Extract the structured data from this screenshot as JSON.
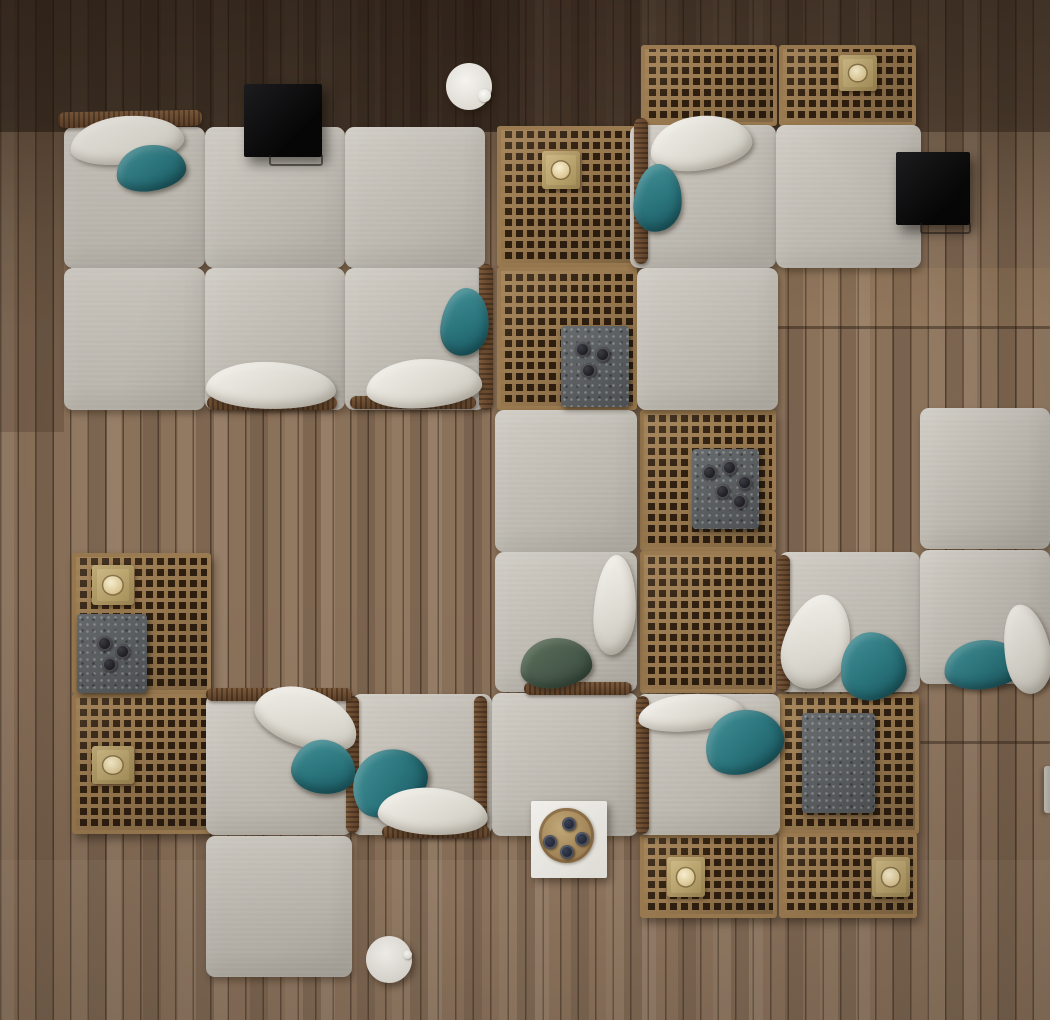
{
  "scene": {
    "title": "Overhead 3D render: modular outdoor lounge sofas with lattice wood coffee tables, teal and white pillows, stone trays and brass candle blocks on a plank deck",
    "canvas": {
      "width": 1050,
      "height": 1020
    },
    "palette": {
      "deck_wood": "#8a715a",
      "deck_wood_dark": "#54422f",
      "plank_line": "#2d1e12",
      "lattice_wood": "#9a7a50",
      "lattice_hole": "#2f1f10",
      "cushion_fabric": "#c3bfb6",
      "pillow_white": "#ece9e2",
      "pillow_teal": "#2d747c",
      "pillow_green": "#47594a",
      "stone_tray": "#5d5f61",
      "brass": "#b59c68",
      "candle_wax": "#f0e4bd",
      "black_table": "#101012",
      "white_table": "#ecebe6",
      "wood_tray": "#b09064",
      "wicker_frame": "#6b4c30"
    },
    "floor": {
      "description": "vertical timber planks, darker at top, lighter toward bottom",
      "plank_width_px": 18
    },
    "items": [
      {
        "name": "floor-shade-top",
        "type": "shade",
        "x": 0,
        "y": 0,
        "w": 1050,
        "h": 132,
        "color": "rgba(28,19,12,0.38)"
      },
      {
        "name": "floor-shade-top-left",
        "type": "shade",
        "x": 0,
        "y": 0,
        "w": 520,
        "h": 132,
        "color": "rgba(24,16,10,0.30)"
      },
      {
        "name": "floor-shade-left-strip",
        "type": "shade",
        "x": 0,
        "y": 132,
        "w": 64,
        "h": 300,
        "color": "rgba(44,31,20,0.20)"
      },
      {
        "name": "floor-shade-mid-top",
        "type": "shade",
        "x": 380,
        "y": 0,
        "w": 260,
        "h": 130,
        "color": "rgba(30,20,13,0.22)"
      },
      {
        "name": "floor-shade-bottom-light",
        "type": "shade",
        "x": 0,
        "y": 860,
        "w": 1050,
        "h": 160,
        "color": "rgba(255,238,214,0.05)"
      },
      {
        "name": "floor-shade-right-gold",
        "type": "shade",
        "x": 778,
        "y": 268,
        "w": 272,
        "h": 58,
        "color": "rgba(214,172,120,0.10)"
      },
      {
        "name": "plank-seam-right-upper",
        "type": "seam",
        "x": 776,
        "y": 326,
        "w": 274,
        "h": 3
      },
      {
        "name": "plank-seam-right-lower",
        "type": "seam",
        "x": 920,
        "y": 741,
        "w": 130,
        "h": 3
      },
      {
        "name": "lattice-panel-mid-top",
        "type": "lattice",
        "x": 497,
        "y": 126,
        "w": 140,
        "h": 141
      },
      {
        "name": "lattice-panel-mid-second",
        "type": "lattice",
        "x": 497,
        "y": 267,
        "w": 140,
        "h": 143
      },
      {
        "name": "lattice-panel-topright-left",
        "type": "lattice",
        "x": 641,
        "y": 45,
        "w": 136,
        "h": 81
      },
      {
        "name": "lattice-panel-topright-right",
        "type": "lattice",
        "x": 779,
        "y": 45,
        "w": 137,
        "h": 81
      },
      {
        "name": "lattice-panel-center-right-upper",
        "type": "lattice",
        "x": 640,
        "y": 410,
        "w": 136,
        "h": 141
      },
      {
        "name": "lattice-panel-center-right-lower",
        "type": "lattice",
        "x": 640,
        "y": 551,
        "w": 136,
        "h": 142
      },
      {
        "name": "lattice-panel-right-tray",
        "type": "lattice",
        "x": 777,
        "y": 694,
        "w": 142,
        "h": 140
      },
      {
        "name": "lattice-panel-bottom-pair-left",
        "type": "lattice",
        "x": 640,
        "y": 834,
        "w": 137,
        "h": 84
      },
      {
        "name": "lattice-panel-bottom-pair-right",
        "type": "lattice",
        "x": 779,
        "y": 833,
        "w": 138,
        "h": 85
      },
      {
        "name": "lattice-panel-west-upper",
        "type": "lattice",
        "x": 72,
        "y": 553,
        "w": 139,
        "h": 141
      },
      {
        "name": "lattice-panel-west-lower",
        "type": "lattice",
        "x": 72,
        "y": 694,
        "w": 139,
        "h": 140
      },
      {
        "name": "cushion-topleft-r1c1",
        "type": "cushion",
        "x": 64,
        "y": 127,
        "w": 141,
        "h": 141
      },
      {
        "name": "cushion-topleft-r1c2",
        "type": "cushion",
        "x": 205,
        "y": 127,
        "w": 140,
        "h": 141
      },
      {
        "name": "cushion-topleft-r1c3",
        "type": "cushion",
        "x": 345,
        "y": 127,
        "w": 140,
        "h": 141
      },
      {
        "name": "cushion-topleft-r2c1",
        "type": "cushion",
        "x": 64,
        "y": 268,
        "w": 141,
        "h": 142
      },
      {
        "name": "cushion-topleft-r2c2",
        "type": "cushion",
        "x": 205,
        "y": 268,
        "w": 140,
        "h": 142
      },
      {
        "name": "cushion-topleft-r2c3",
        "type": "cushion",
        "x": 345,
        "y": 268,
        "w": 140,
        "h": 142
      },
      {
        "name": "cushion-topright-seat",
        "type": "cushion",
        "x": 630,
        "y": 125,
        "w": 146,
        "h": 143
      },
      {
        "name": "cushion-topright-end",
        "type": "cushion",
        "x": 776,
        "y": 125,
        "w": 145,
        "h": 143
      },
      {
        "name": "cushion-topright-below",
        "type": "cushion",
        "x": 637,
        "y": 268,
        "w": 141,
        "h": 142
      },
      {
        "name": "cushion-middle-upper",
        "type": "cushion",
        "x": 495,
        "y": 410,
        "w": 142,
        "h": 142
      },
      {
        "name": "cushion-middle-seat",
        "type": "cushion",
        "x": 495,
        "y": 552,
        "w": 142,
        "h": 140
      },
      {
        "name": "cushion-far-right-upper",
        "type": "cushion",
        "x": 920,
        "y": 408,
        "w": 130,
        "h": 141
      },
      {
        "name": "cushion-right-seat",
        "type": "cushion",
        "x": 779,
        "y": 552,
        "w": 141,
        "h": 140
      },
      {
        "name": "cushion-right-end",
        "type": "cushion",
        "x": 920,
        "y": 550,
        "w": 130,
        "h": 134
      },
      {
        "name": "cushion-bottomleft-seat1",
        "type": "cushion",
        "x": 206,
        "y": 694,
        "w": 146,
        "h": 141
      },
      {
        "name": "cushion-bottomleft-seat2",
        "type": "cushion",
        "x": 352,
        "y": 694,
        "w": 140,
        "h": 141
      },
      {
        "name": "cushion-bottom-middle",
        "type": "cushion",
        "x": 492,
        "y": 693,
        "w": 146,
        "h": 143
      },
      {
        "name": "cushion-bottom-seat3",
        "type": "cushion",
        "x": 637,
        "y": 694,
        "w": 143,
        "h": 141
      },
      {
        "name": "cushion-ottoman-bottomleft",
        "type": "cushion",
        "x": 206,
        "y": 836,
        "w": 146,
        "h": 141
      },
      {
        "name": "wicker-back-topleft",
        "type": "wicker",
        "x": 58,
        "y": 111,
        "w": 144,
        "h": 16,
        "rot": -1
      },
      {
        "name": "wicker-arm-topleft-right",
        "type": "wicker",
        "x": 479,
        "y": 264,
        "w": 14,
        "h": 146
      },
      {
        "name": "wicker-frame-under-r2c2",
        "type": "wicker",
        "x": 207,
        "y": 396,
        "w": 130,
        "h": 14
      },
      {
        "name": "wicker-frame-under-r2c3",
        "type": "wicker",
        "x": 350,
        "y": 396,
        "w": 126,
        "h": 13
      },
      {
        "name": "wicker-arm-topright-left",
        "type": "wicker",
        "x": 634,
        "y": 118,
        "w": 14,
        "h": 146
      },
      {
        "name": "wicker-arm-rightseat-left",
        "type": "wicker",
        "x": 777,
        "y": 555,
        "w": 13,
        "h": 136
      },
      {
        "name": "wicker-arm-bottomseat3-left",
        "type": "wicker",
        "x": 636,
        "y": 696,
        "w": 13,
        "h": 138
      },
      {
        "name": "wicker-frame-under-middle-seat",
        "type": "wicker",
        "x": 524,
        "y": 682,
        "w": 108,
        "h": 13
      },
      {
        "name": "wicker-arm-bottomleft-mid",
        "type": "wicker",
        "x": 346,
        "y": 696,
        "w": 13,
        "h": 137
      },
      {
        "name": "wicker-arm-bottomleft-right",
        "type": "wicker",
        "x": 474,
        "y": 696,
        "w": 13,
        "h": 137
      },
      {
        "name": "wicker-back-bottomleft",
        "type": "wicker",
        "x": 206,
        "y": 688,
        "w": 146,
        "h": 13
      },
      {
        "name": "wicker-frame-under-seat2",
        "type": "wicker",
        "x": 382,
        "y": 826,
        "w": 108,
        "h": 12
      },
      {
        "name": "stone-tray-mid",
        "type": "stone-tray",
        "x": 561,
        "y": 326,
        "w": 68,
        "h": 81,
        "cups": [
          [
            14,
            16
          ],
          [
            34,
            21
          ],
          [
            20,
            37
          ]
        ]
      },
      {
        "name": "stone-tray-center-right",
        "type": "stone-tray",
        "x": 692,
        "y": 449,
        "w": 67,
        "h": 80,
        "cups": [
          [
            10,
            16
          ],
          [
            30,
            11
          ],
          [
            45,
            26
          ],
          [
            23,
            35
          ],
          [
            40,
            45
          ]
        ]
      },
      {
        "name": "stone-tray-west",
        "type": "stone-tray",
        "x": 77,
        "y": 614,
        "w": 70,
        "h": 79,
        "cups": [
          [
            20,
            22
          ],
          [
            38,
            30
          ],
          [
            25,
            43
          ]
        ]
      },
      {
        "name": "stone-tray-right-plain",
        "type": "stone-tray",
        "x": 802,
        "y": 713,
        "w": 73,
        "h": 100,
        "cups": []
      },
      {
        "name": "candle-block-mid-top",
        "type": "candle",
        "x": 542,
        "y": 151,
        "w": 38,
        "h": 38
      },
      {
        "name": "candle-block-topright",
        "type": "candle",
        "x": 839,
        "y": 55,
        "w": 38,
        "h": 36
      },
      {
        "name": "candle-block-west-upper",
        "type": "candle",
        "x": 92,
        "y": 565,
        "w": 42,
        "h": 40
      },
      {
        "name": "candle-block-west-lower",
        "type": "candle",
        "x": 92,
        "y": 746,
        "w": 42,
        "h": 38
      },
      {
        "name": "candle-block-bottom-left",
        "type": "candle",
        "x": 667,
        "y": 857,
        "w": 38,
        "h": 40
      },
      {
        "name": "candle-block-bottom-right",
        "type": "candle",
        "x": 872,
        "y": 857,
        "w": 38,
        "h": 40
      },
      {
        "name": "pillow-white-topleft",
        "type": "pillow-white",
        "x": 70,
        "y": 116,
        "w": 114,
        "h": 48,
        "rot": -5
      },
      {
        "name": "pillow-teal-topleft",
        "type": "pillow-teal",
        "x": 116,
        "y": 145,
        "w": 70,
        "h": 46,
        "rot": -7
      },
      {
        "name": "pillow-white-r2c2",
        "type": "pillow-white",
        "x": 206,
        "y": 362,
        "w": 130,
        "h": 47,
        "rot": 2
      },
      {
        "name": "pillow-teal-r2c3",
        "type": "pillow-teal",
        "x": 441,
        "y": 288,
        "w": 48,
        "h": 68,
        "rot": 6
      },
      {
        "name": "pillow-white-r2c3",
        "type": "pillow-white",
        "x": 366,
        "y": 359,
        "w": 116,
        "h": 49,
        "rot": -3
      },
      {
        "name": "pillow-white-topright",
        "type": "pillow-white",
        "x": 650,
        "y": 116,
        "w": 102,
        "h": 54,
        "rot": -7
      },
      {
        "name": "pillow-teal-topright",
        "type": "pillow-teal",
        "x": 634,
        "y": 164,
        "w": 48,
        "h": 68,
        "rot": 4
      },
      {
        "name": "pillow-white-middle-seat",
        "type": "pillow-white",
        "x": 594,
        "y": 555,
        "w": 42,
        "h": 100,
        "rot": 3
      },
      {
        "name": "pillow-green-middle-seat",
        "type": "pillow-green",
        "x": 520,
        "y": 638,
        "w": 72,
        "h": 50,
        "rot": -5
      },
      {
        "name": "pillow-white-bl-seat1",
        "type": "pillow-white",
        "x": 254,
        "y": 690,
        "w": 106,
        "h": 57,
        "rot": 21
      },
      {
        "name": "pillow-teal-bl-seat1",
        "type": "pillow-teal",
        "x": 292,
        "y": 740,
        "w": 64,
        "h": 54,
        "rot": 12
      },
      {
        "name": "pillow-teal-bl-seat2",
        "type": "pillow-teal",
        "x": 350,
        "y": 750,
        "w": 78,
        "h": 64,
        "rot": -27
      },
      {
        "name": "pillow-white-bl-seat2",
        "type": "pillow-white",
        "x": 378,
        "y": 788,
        "w": 110,
        "h": 47,
        "rot": 4
      },
      {
        "name": "pillow-white-bottom-seat3",
        "type": "pillow-white",
        "x": 638,
        "y": 694,
        "w": 106,
        "h": 37,
        "rot": -4
      },
      {
        "name": "pillow-teal-bottom-seat3",
        "type": "pillow-teal",
        "x": 704,
        "y": 710,
        "w": 80,
        "h": 63,
        "rot": -16
      },
      {
        "name": "pillow-white-right-seat",
        "type": "pillow-white",
        "x": 784,
        "y": 594,
        "w": 66,
        "h": 96,
        "rot": 15
      },
      {
        "name": "pillow-teal-right-seat",
        "type": "pillow-teal",
        "x": 840,
        "y": 632,
        "w": 66,
        "h": 68,
        "rot": -8
      },
      {
        "name": "pillow-teal-right-end",
        "type": "pillow-teal",
        "x": 944,
        "y": 640,
        "w": 80,
        "h": 49,
        "rot": -5
      },
      {
        "name": "pillow-white-right-end",
        "type": "pillow-white",
        "x": 1004,
        "y": 604,
        "w": 46,
        "h": 90,
        "rot": -10
      },
      {
        "name": "black-side-table-topleft",
        "type": "black-table",
        "x": 244,
        "y": 84,
        "w": 78,
        "h": 73
      },
      {
        "name": "black-side-table-topright",
        "type": "black-table",
        "x": 896,
        "y": 152,
        "w": 74,
        "h": 73
      },
      {
        "name": "round-side-table-top",
        "type": "round-table",
        "x": 446,
        "y": 63,
        "w": 46,
        "h": 47,
        "knob": [
          32,
          26,
          13
        ]
      },
      {
        "name": "round-side-table-bottom",
        "type": "round-table",
        "x": 366,
        "y": 936,
        "w": 46,
        "h": 47,
        "knob": [
          37,
          14,
          9
        ]
      },
      {
        "name": "tray-table-bottom-center",
        "type": "tray-table",
        "x": 531,
        "y": 801,
        "w": 76,
        "h": 77,
        "cups": [
          [
            31,
            16
          ],
          [
            12,
            34
          ],
          [
            44,
            31
          ],
          [
            29,
            44
          ]
        ]
      },
      {
        "name": "deck-sliver-right-edge",
        "type": "sliver",
        "x": 1044,
        "y": 766,
        "w": 6,
        "h": 47
      }
    ]
  }
}
